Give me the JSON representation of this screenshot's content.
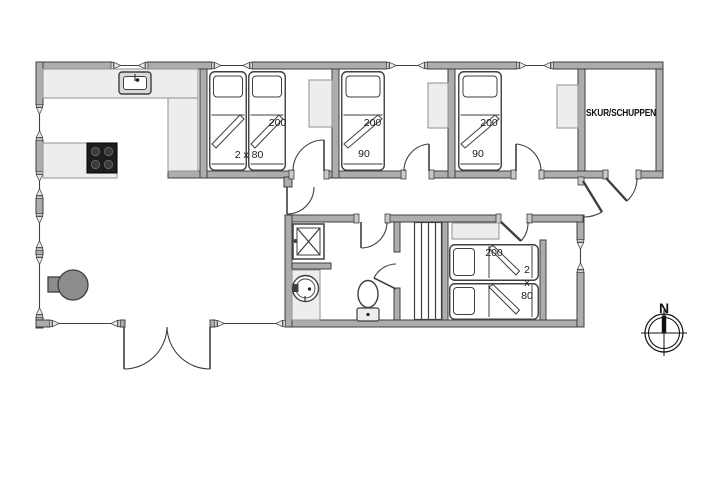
{
  "floorplan": {
    "labels": {
      "shed": "SKUR/SCHUPPEN",
      "compass_north": "N",
      "bedroom1": {
        "length": "200",
        "width": "2 x 80"
      },
      "bedroom2": {
        "length": "200",
        "width": "90"
      },
      "bedroom3": {
        "length": "200",
        "width": "90"
      },
      "bedroom4": {
        "length": "200",
        "width_line1": "2",
        "width_line2": "x",
        "width_line3": "80"
      }
    },
    "colors": {
      "wall_fill": "#adadad",
      "line": "#3f3f3f",
      "furniture_fill": "#ededed",
      "appliance_dark": "#8c8c8c",
      "cooktop": "#1d1d1d",
      "background": "#ffffff"
    }
  }
}
